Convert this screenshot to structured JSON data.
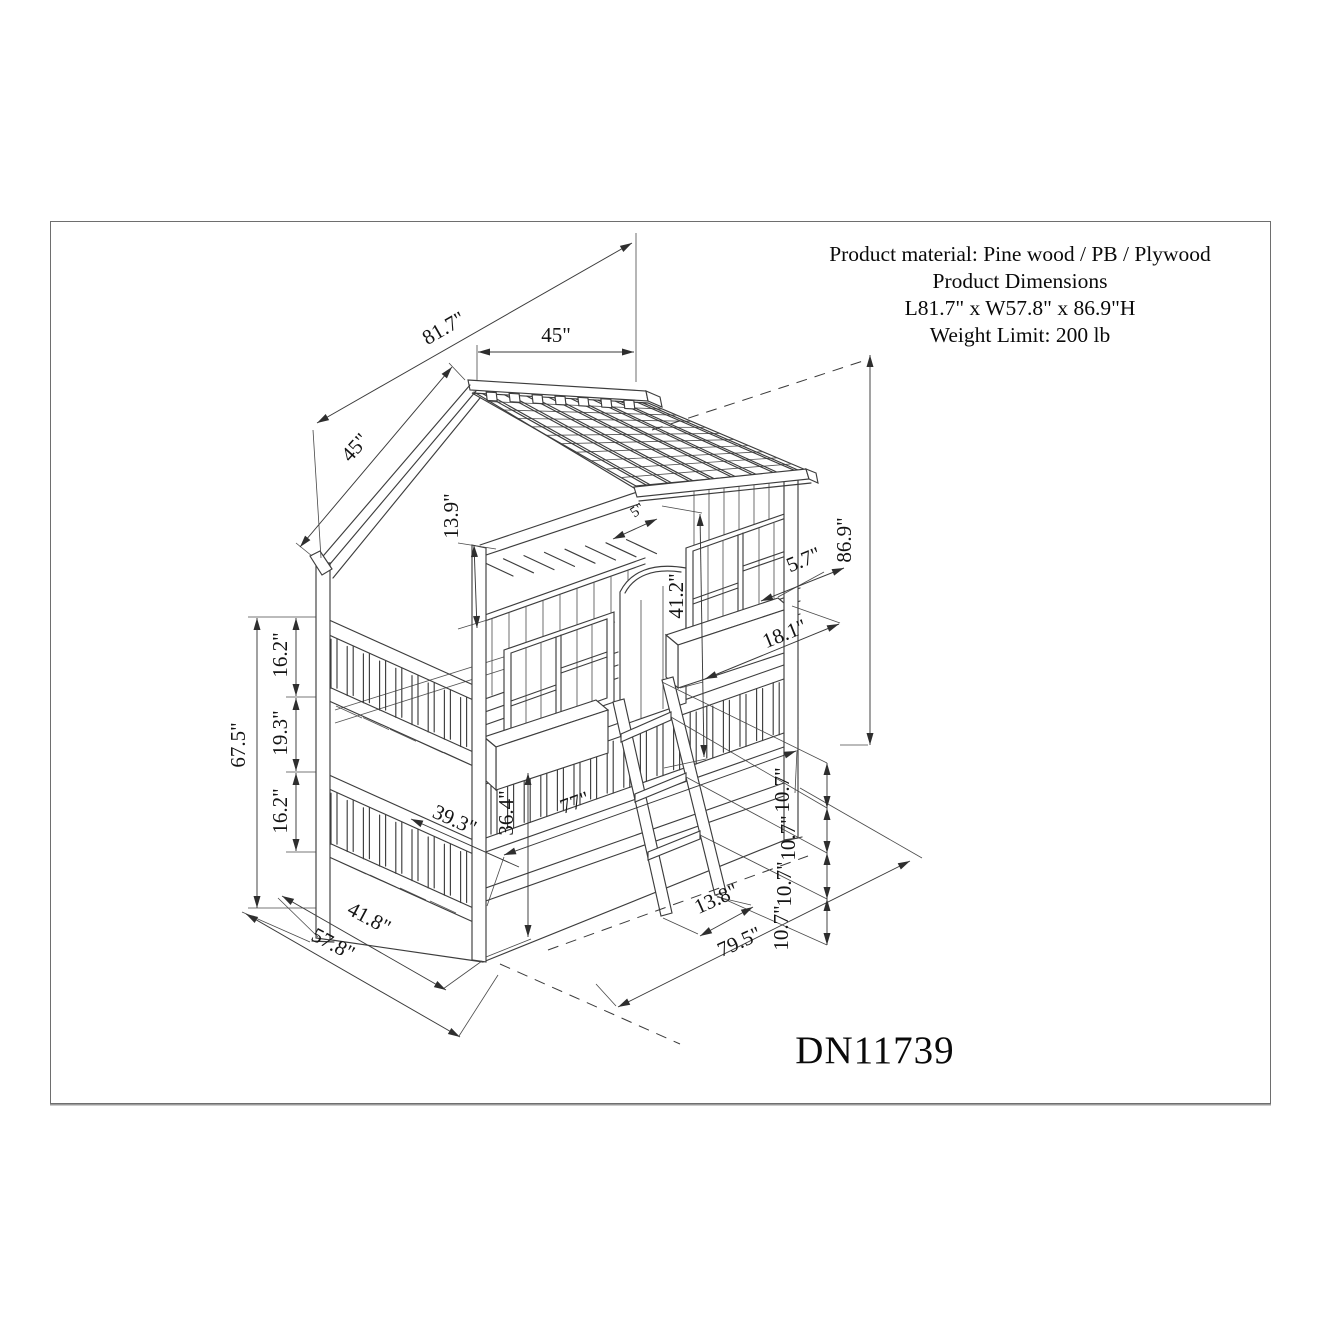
{
  "product_info": {
    "line1": "Product material: Pine wood / PB / Plywood",
    "line2": "Product Dimensions",
    "line3": "L81.7\" x W57.8\" x 86.9\"H",
    "line4": "Weight Limit: 200 lb"
  },
  "model_number": "DN11739",
  "dims": {
    "roof_length": "81.7\"",
    "roof_top": "45\"",
    "roof_slope": "45\"",
    "roof_overhang": "13.9\"",
    "total_height": "86.9\"",
    "wall_height": "41.2\"",
    "door_gap": "5\"",
    "window_box_depth": "5.7\"",
    "window_box_length": "18.1\"",
    "side_rail_total": "67.5\"",
    "upper_rail": "16.2\"",
    "rail_gap": "19.3\"",
    "lower_rail": "16.2\"",
    "bunk_width": "39.3\"",
    "bunk_clearance": "36.4\"",
    "bed_length": "77\"",
    "ladder_offset": "13.8\"",
    "floor_length": "79.5\"",
    "step1": "10.7\"",
    "step2": "10.7\"",
    "step3": "10.7\"",
    "step4": "10.7\"",
    "width_inner": "41.8\"",
    "width_total": "57.8\""
  },
  "colors": {
    "line": "#3d3d3d",
    "dim": "#3a3a3a",
    "frame": "#6e6e6e",
    "text": "#141414"
  }
}
